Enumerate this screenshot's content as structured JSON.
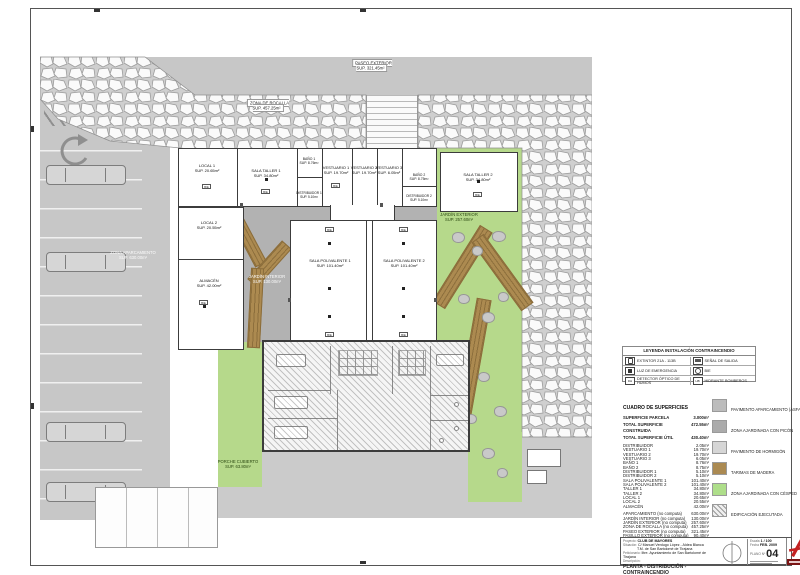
{
  "plan": {
    "areas": {
      "paseo_exterior": {
        "name": "PASEO EXTERIOR",
        "sup": "SUP. 321.45m²"
      },
      "zona_rocalla": {
        "name": "ZONA DE ROCALLA",
        "sup": "SUP. 457.25m²"
      },
      "aparcamiento": {
        "name": "ZONA APARCAMIENTO",
        "sup": "SUP. 630.00m²"
      },
      "jardin_interior": {
        "name": "JARDÍN INTERIOR",
        "sup": "SUP. 130.00m²"
      },
      "jardin_exterior": {
        "name": "JARDÍN EXTERIOR",
        "sup": "SUP. 257.60m²"
      },
      "porche_cubierto": {
        "name": "PORCHE CUBIERTO",
        "sup": "SUP. 63.80m²"
      }
    },
    "rooms": [
      {
        "name": "LOCAL 1",
        "sup": "SUP. 20.65m²"
      },
      {
        "name": "SALA TALLER 1",
        "sup": "SUP. 34.80m²"
      },
      {
        "name": "BAÑO 1",
        "sup": "SUP. 8.76m²"
      },
      {
        "name": "DISTRIBUIDOR 1",
        "sup": "SUP. 5.10m²"
      },
      {
        "name": "VESTUARIO 1",
        "sup": "SUP. 19.70m²"
      },
      {
        "name": "VESTUARIO 2",
        "sup": "SUP. 19.70m²"
      },
      {
        "name": "VESTUARIO 3",
        "sup": "SUP. 6.05m²"
      },
      {
        "name": "BAÑO 2",
        "sup": "SUP. 8.75m²"
      },
      {
        "name": "DISTRIBUIDOR 2",
        "sup": "SUP. 5.10m²"
      },
      {
        "name": "SALA TALLER 2",
        "sup": "SUP. 34.80m²"
      },
      {
        "name": "LOCAL 2",
        "sup": "SUP. 20.55m²"
      },
      {
        "name": "ALMACÉN",
        "sup": "SUP. 42.00m²"
      },
      {
        "name": "SALA POLIVALENTE 1",
        "sup": "SUP. 101.40m²"
      },
      {
        "name": "SALA POLIVALENTE 2",
        "sup": "SUP. 101.40m²"
      }
    ],
    "symbols": {
      "bie": "BIE"
    }
  },
  "fire_legend": {
    "title": "LEYENDA INSTALACIÓN CONTRAINCENDIO",
    "rows": [
      {
        "left": "EXTINTOR 21A - 113B",
        "left_icon": "extinguisher-icon",
        "right": "SEÑAL DE SALIDA",
        "right_icon": "exit-sign-icon"
      },
      {
        "left": "LUZ DE EMERGENCIA",
        "left_icon": "emergency-light-icon",
        "right": "BIE",
        "right_icon": "bie-icon"
      },
      {
        "left": "DETECTOR ÓPTICO DE HUMOS",
        "left_icon": "smoke-detector-icon",
        "right": "HIDRANTE BOMBEROS",
        "right_icon": "hydrant-icon"
      }
    ],
    "icon_glyphs": {
      "smoke_detector": "DH",
      "hydrant": "HB"
    }
  },
  "surfaces": {
    "title": "CUADRO DE SUPERFICIES",
    "totals": [
      {
        "label": "SUPERFICIE PARCELA",
        "value": "3.000m²"
      },
      {
        "label": "TOTAL SUPERFICIE CONSTRUIDA",
        "value": "472.55m²"
      },
      {
        "label": "TOTAL SUPERFICIE ÚTIL",
        "value": "430.40m²"
      }
    ],
    "interior": [
      {
        "label": "DISTRIBUIDOR",
        "value": "2.05m²"
      },
      {
        "label": "VESTUARIO 1",
        "value": "19.70m²"
      },
      {
        "label": "VESTUARIO 2",
        "value": "19.70m²"
      },
      {
        "label": "VESTUARIO 3",
        "value": "6.05m²"
      },
      {
        "label": "BAÑO 1",
        "value": "8.76m²"
      },
      {
        "label": "BAÑO 2",
        "value": "8.75m²"
      },
      {
        "label": "DISTRIBUIDOR 1",
        "value": "5.10m²"
      },
      {
        "label": "DISTRIBUIDOR 2",
        "value": "5.10m²"
      },
      {
        "label": "SALA POLIVALENTE 1",
        "value": "101.40m²"
      },
      {
        "label": "SALA POLIVALENTE 2",
        "value": "101.40m²"
      },
      {
        "label": "TALLER 1",
        "value": "34.80m²"
      },
      {
        "label": "TALLER 2",
        "value": "34.80m²"
      },
      {
        "label": "LOCAL 1",
        "value": "20.65m²"
      },
      {
        "label": "LOCAL 2",
        "value": "20.55m²"
      },
      {
        "label": "ALMACÉN",
        "value": "42.00m²"
      }
    ],
    "exterior": [
      {
        "label": "APARCAMIENTO (no computa)",
        "value": "630.00m²"
      },
      {
        "label": "JARDÍN INTERIOR (no computa)",
        "value": "130.00m²"
      },
      {
        "label": "JARDÍN EXTERIOR (no computa)",
        "value": "257.60m²"
      },
      {
        "label": "ZONA DE ROCALLA (no computa)",
        "value": "457.25m²"
      },
      {
        "label": "PASEO EXTERIOR (no computa)",
        "value": "321.45m²"
      },
      {
        "label": "PASILLO EXTERIOR (no computa)",
        "value": "90.40m²"
      }
    ]
  },
  "materials": [
    {
      "label": "PAVIMENTO APARCAMIENTO (ASFALTO)",
      "color": "#bcbcbc",
      "fill": "solid"
    },
    {
      "label": "ZONA AJARDINADA CON PICÓN",
      "color": "#ababab",
      "fill": "solid"
    },
    {
      "label": "PAVIMENTO DE HORMIGÓN",
      "color": "#d6d6d6",
      "fill": "solid"
    },
    {
      "label": "TARIMAS DE MADERA",
      "color": "#ab8a52",
      "fill": "solid"
    },
    {
      "label": "ZONA AJARDINADA CON CÉSPED",
      "color": "#aede8a",
      "fill": "solid"
    },
    {
      "label": "EDIFICACIÓN EJECUTADA",
      "color": "#bdbdbd",
      "fill": "hatch"
    }
  ],
  "title_block": {
    "proyecto_label": "Proyecto:",
    "proyecto": "CLUB DE MAYORES",
    "situacion_label": "Situación:",
    "situacion1": "C/ Manuel Verdugo López - Aldea Blanca",
    "situacion2": "T.M. de San Bartolomé de Tirajana",
    "peticionario_label": "Peticionario:",
    "peticionario": "Iltre. Ayuntamiento de San Bartolomé de Tirajana",
    "descripcion_label": "Descripción:",
    "drawing_title": "PLANTA - DISTRIBUCIÓN - CONTRAINCENDIO",
    "escala_label": "Escala",
    "escala": "1 / 100",
    "fecha_label": "Fecha",
    "fecha": "FEB. 2009",
    "plano_label": "PLANO Nº",
    "plano": "04"
  }
}
